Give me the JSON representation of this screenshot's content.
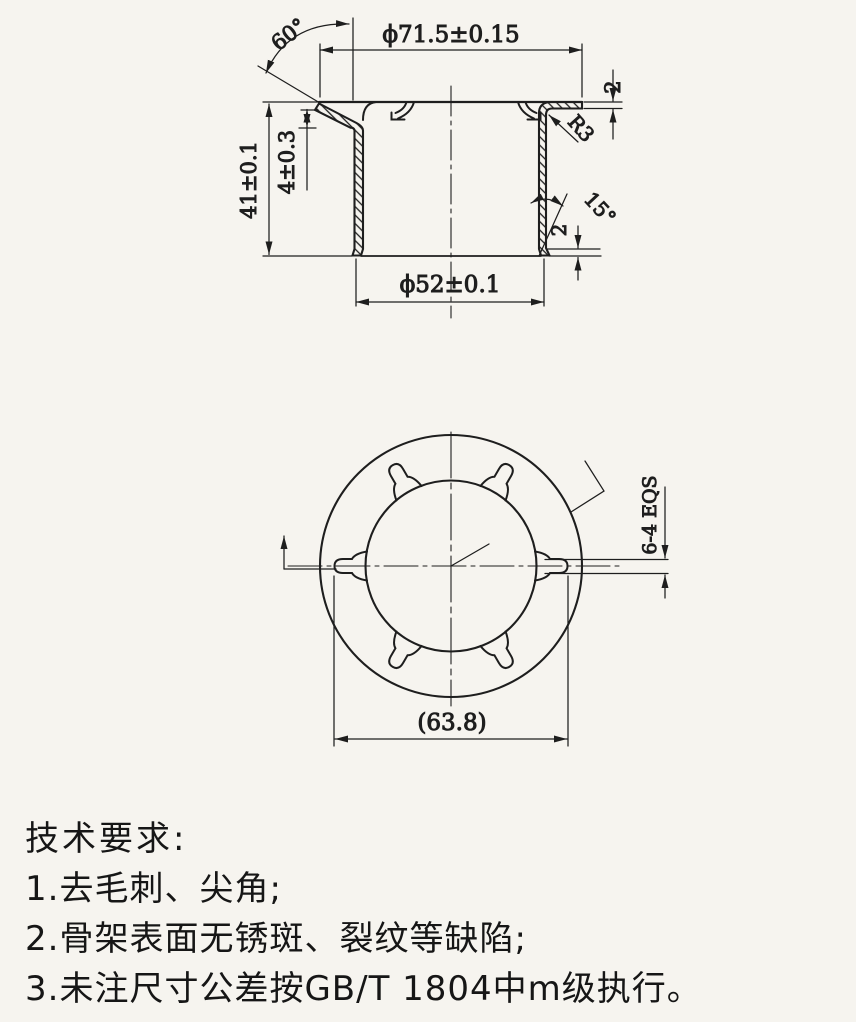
{
  "drawing": {
    "section_view": {
      "dim_flange_od": "ϕ71.5±0.15",
      "dim_angle_top": "60°",
      "dim_flange_thickness": "2",
      "dim_radius": "R3",
      "dim_height": "41±0.1",
      "dim_tab_drop": "4±0.3",
      "dim_flare_angle": "15°",
      "dim_flare_height": "2",
      "dim_bottom_od": "ϕ52±0.1"
    },
    "plan_view": {
      "dim_tab_width": "6-4 EQS",
      "dim_tab_tip_diameter": "(63.8)"
    }
  },
  "notes": {
    "title": "技术要求:",
    "items": [
      "1.去毛刺、尖角;",
      "2.骨架表面无锈斑、裂纹等缺陷;",
      "3.未注尺寸公差按GB/T 1804中m级执行。"
    ]
  },
  "colors": {
    "line": "#1e1e1e",
    "paper": "#f6f4ef"
  }
}
